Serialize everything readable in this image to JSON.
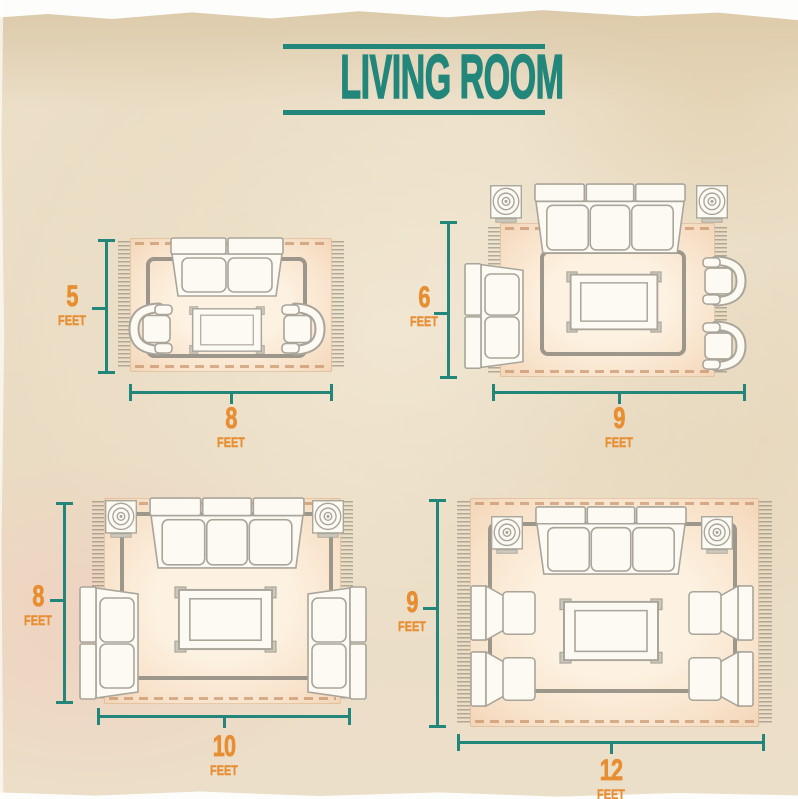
{
  "title": "LIVING ROOM",
  "colors": {
    "teal": "#23867b",
    "orange": "#e78e33",
    "rug": "#f7dcc3",
    "rug_center": "#fdf2e2",
    "background": "#e9dcc5",
    "furniture_outline": "#a9a59b"
  },
  "diagrams": [
    {
      "name": "rug-5x8",
      "height": {
        "value": "5",
        "unit": "FEET"
      },
      "width": {
        "value": "8",
        "unit": "FEET"
      },
      "furniture": [
        "loveseat-sofa",
        "armchair",
        "armchair",
        "coffee-table"
      ]
    },
    {
      "name": "rug-6x9",
      "height": {
        "value": "6",
        "unit": "FEET"
      },
      "width": {
        "value": "9",
        "unit": "FEET"
      },
      "furniture": [
        "side-table",
        "side-table",
        "three-seat-sofa",
        "loveseat-sofa",
        "armchair",
        "armchair",
        "coffee-table"
      ]
    },
    {
      "name": "rug-8x10",
      "height": {
        "value": "8",
        "unit": "FEET"
      },
      "width": {
        "value": "10",
        "unit": "FEET"
      },
      "furniture": [
        "side-table",
        "side-table",
        "three-seat-sofa",
        "loveseat-sofa",
        "loveseat-sofa",
        "coffee-table"
      ]
    },
    {
      "name": "rug-9x12",
      "height": {
        "value": "9",
        "unit": "FEET"
      },
      "width": {
        "value": "12",
        "unit": "FEET"
      },
      "furniture": [
        "side-table",
        "side-table",
        "three-seat-sofa",
        "armchair",
        "armchair",
        "armchair",
        "armchair",
        "coffee-table"
      ]
    }
  ]
}
